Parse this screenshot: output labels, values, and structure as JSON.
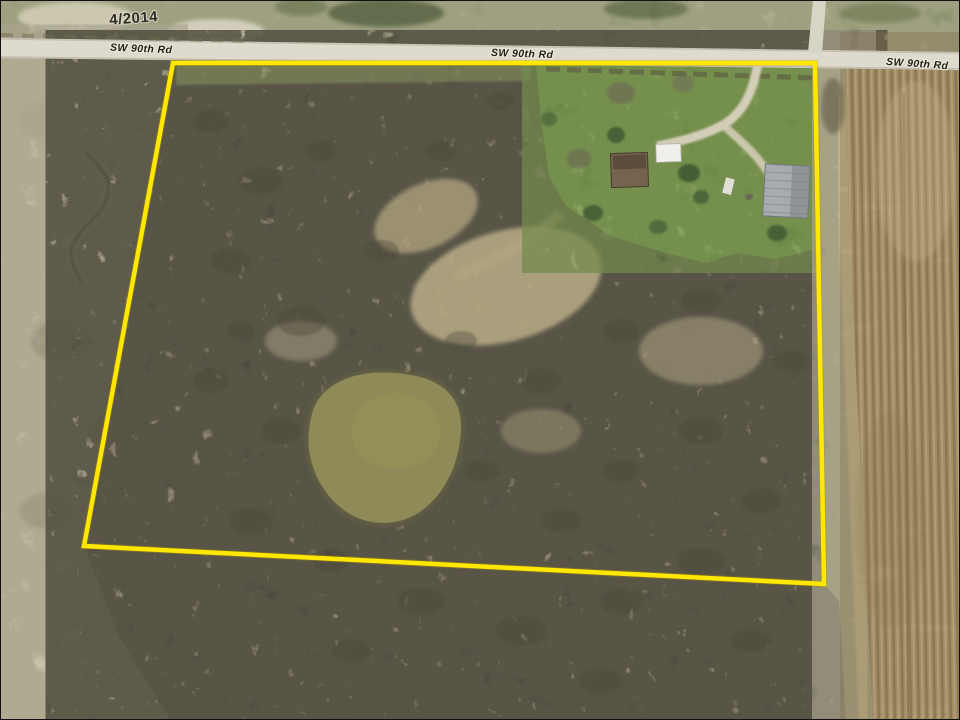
{
  "view": {
    "title": "aerial-property-boundary-view",
    "imagery_date": "4/2014"
  },
  "roads": {
    "labels": [
      {
        "id": "road-label-west",
        "text": "SW 90th Rd"
      },
      {
        "id": "road-label-center",
        "text": "SW 90th Rd"
      },
      {
        "id": "road-label-east",
        "text": "SW 90th Rd"
      }
    ]
  },
  "boundary": {
    "points": "172,62 814,62 823,583 83,545",
    "color": "#ffe800",
    "stroke_width": "4.5"
  },
  "colors": {
    "road": "#dedacd",
    "lawn": "#7c9b53",
    "scrub": "#7d7767",
    "pasture": "#bcb69a",
    "pond": "#8f8b59",
    "field_base": "#b29c74",
    "east_strip": "#9b9a72",
    "barn_roof": "#a7acb0",
    "shed_roof": "#f0efe9",
    "house_roof": "#75634f",
    "driveway": "#d9d2bd"
  }
}
